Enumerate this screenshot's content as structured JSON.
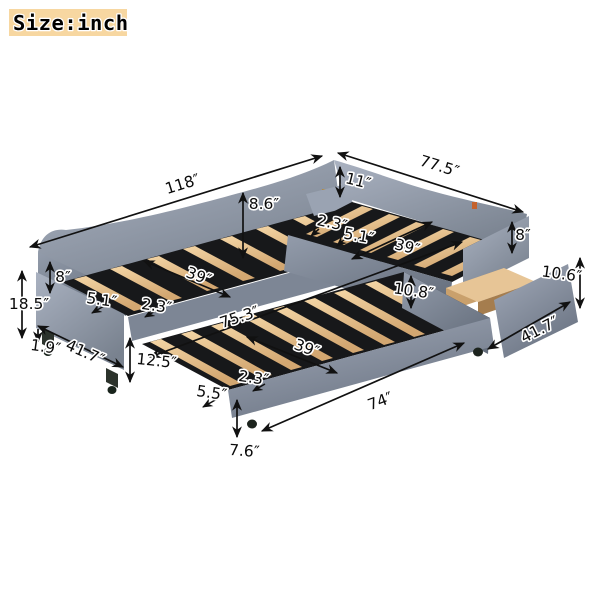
{
  "size_badge": {
    "label": "Size:inch",
    "bg_color": "#f7d7a1"
  },
  "palette": {
    "fabric": "#8a93a3",
    "fabric_shadow": "#6e7787",
    "slats": "#e9c593",
    "wood": "#d2ab79",
    "deck": "#17181a",
    "dimension_lines": "#111111",
    "label_text": "#000000",
    "label_halo": "#ffffff",
    "background": "#ffffff"
  },
  "dimensions": {
    "main_bed_length": "118″",
    "right_bed_length": "77.5″",
    "headboard_rail_height": "8.6″",
    "corner_rail_height": "11″",
    "right_slat_gap": "2.3″",
    "right_slat_width": "5.1″",
    "right_bed_width": "39″",
    "right_foot_rail_height": "8″",
    "drawer_height": "10.6″",
    "drawer_length": "41.7″",
    "inner_side_rail_height": "10.8″",
    "inner_length": "75.3″",
    "left_rail_height": "8″",
    "left_total_height": "18.5″",
    "left_bed_width": "39″",
    "left_slat_width": "5.1″",
    "left_slat_gap": "2.3″",
    "left_leg_height": "1.9″",
    "left_base_length": "41.7″",
    "trundle_clearance_height": "12.5″",
    "trundle_width": "39″",
    "trundle_slat_gap": "2.3″",
    "trundle_slat_spacing": "5.5″",
    "trundle_length": "74″",
    "trundle_rail_height": "7.6″"
  }
}
